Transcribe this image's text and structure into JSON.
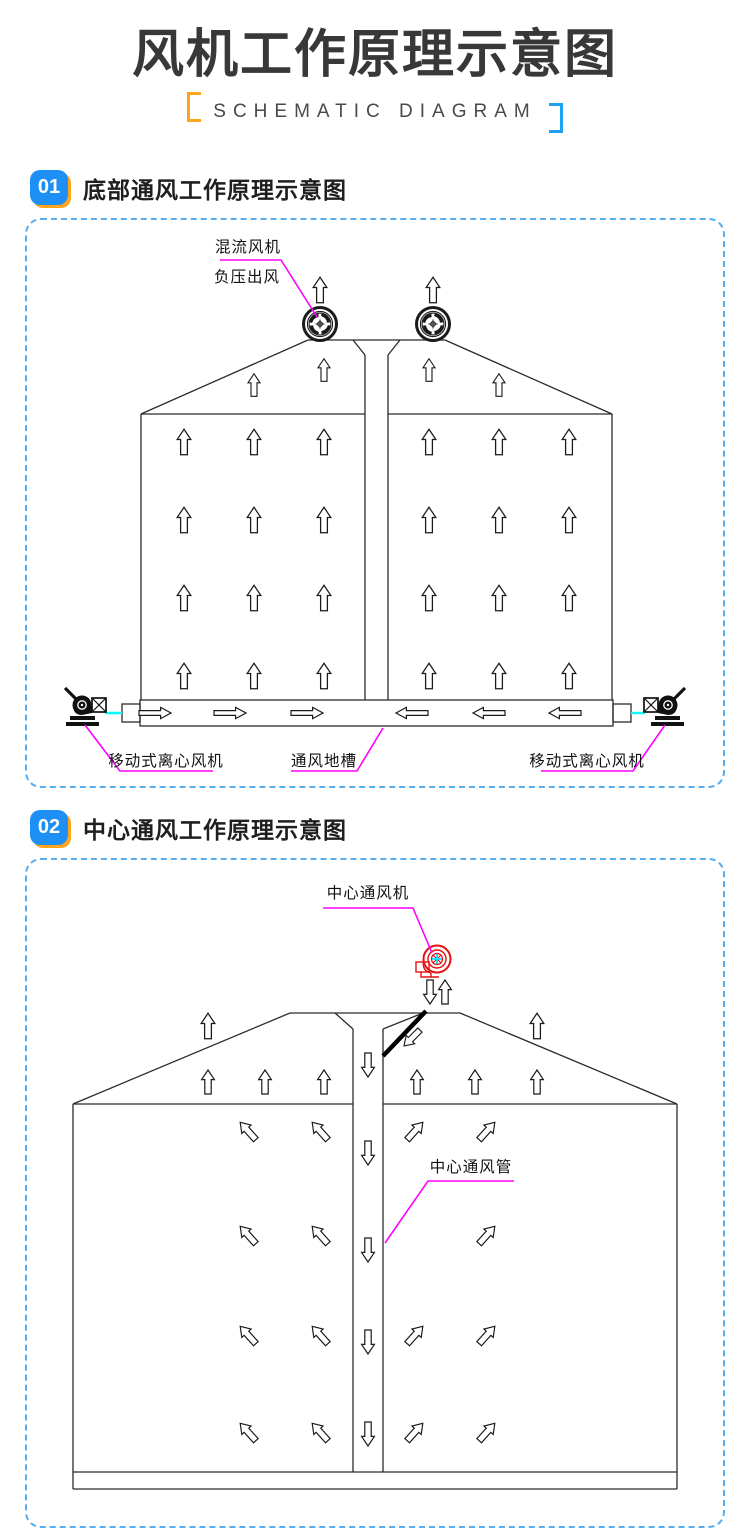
{
  "header": {
    "title": "风机工作原理示意图",
    "subtitle": "SCHEMATIC DIAGRAM"
  },
  "sections": [
    {
      "number": "01",
      "title": "底部通风工作原理示意图"
    },
    {
      "number": "02",
      "title": "中心通风工作原理示意图"
    }
  ],
  "diagram1": {
    "labels": {
      "mixed_flow_fan": "混流风机",
      "negative_pressure_outlet": "负压出风",
      "left_mobile_fan": "移动式离心风机",
      "ventilation_trench": "通风地槽",
      "right_mobile_fan": "移动式离心风机"
    }
  },
  "diagram2": {
    "labels": {
      "center_fan": "中心通风机",
      "center_duct": "中心通风管"
    }
  },
  "colors": {
    "title_text": "#383838",
    "badge_blue": "#1E90F5",
    "badge_shadow_orange": "#FFA41B",
    "bracket_orange": "#FFA41B",
    "bracket_blue": "#1FA2F5",
    "panel_border_blue": "#56AEF0",
    "leader_magenta": "#FF00FF",
    "pipe_cyan": "#00FFFF",
    "fan_red": "#E51010",
    "cad_line": "#2B2B2B"
  }
}
